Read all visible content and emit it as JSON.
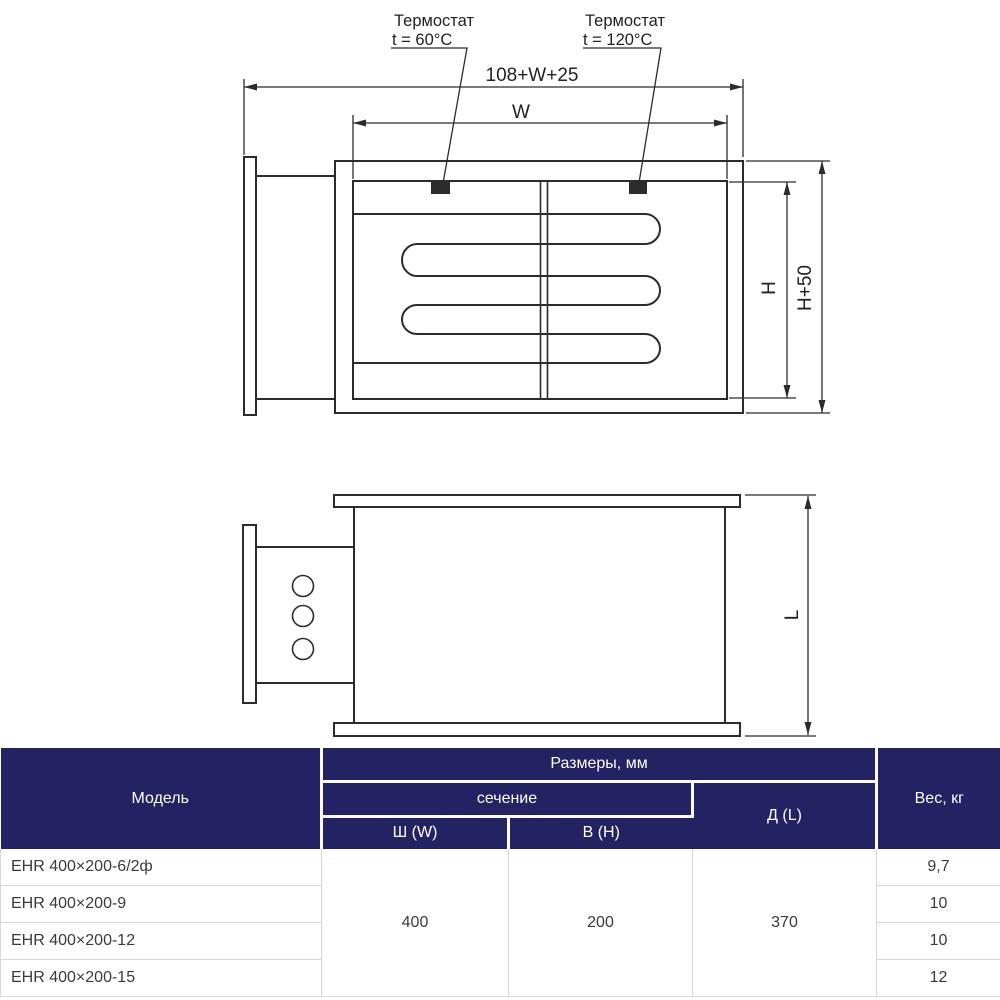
{
  "page": {
    "background": "#ffffff"
  },
  "drawing": {
    "stroke_color": "#2c2c2c",
    "thermostat_marker_color": "#161616",
    "front_view": {
      "thermostat_left": {
        "title": "Термостат",
        "setting": "t = 60°C"
      },
      "thermostat_right": {
        "title": "Термостат",
        "setting": "t = 120°C"
      },
      "dim_total_width": "108+W+25",
      "dim_duct_width": "W",
      "dim_duct_height": "H",
      "dim_case_height": "H+50"
    },
    "side_view": {
      "dim_length": "L"
    }
  },
  "table": {
    "colors": {
      "header_bg": "#232364",
      "header_text": "#ffffff",
      "body_text": "#3a3a3e",
      "grid": "#d6d6db"
    },
    "header": {
      "model": "Модель",
      "dimensions_group": "Размеры, мм",
      "section_group": "сечение",
      "width_col": "Ш (W)",
      "height_col": "В (H)",
      "length_col": "Д (L)",
      "weight_col": "Вес, кг"
    },
    "shared": {
      "width": "400",
      "height": "200",
      "length": "370"
    },
    "rows": [
      {
        "model": "EHR 400×200-6/2ф",
        "weight": "9,7"
      },
      {
        "model": "EHR 400×200-9",
        "weight": "10"
      },
      {
        "model": "EHR 400×200-12",
        "weight": "10"
      },
      {
        "model": "EHR 400×200-15",
        "weight": "12"
      }
    ]
  }
}
